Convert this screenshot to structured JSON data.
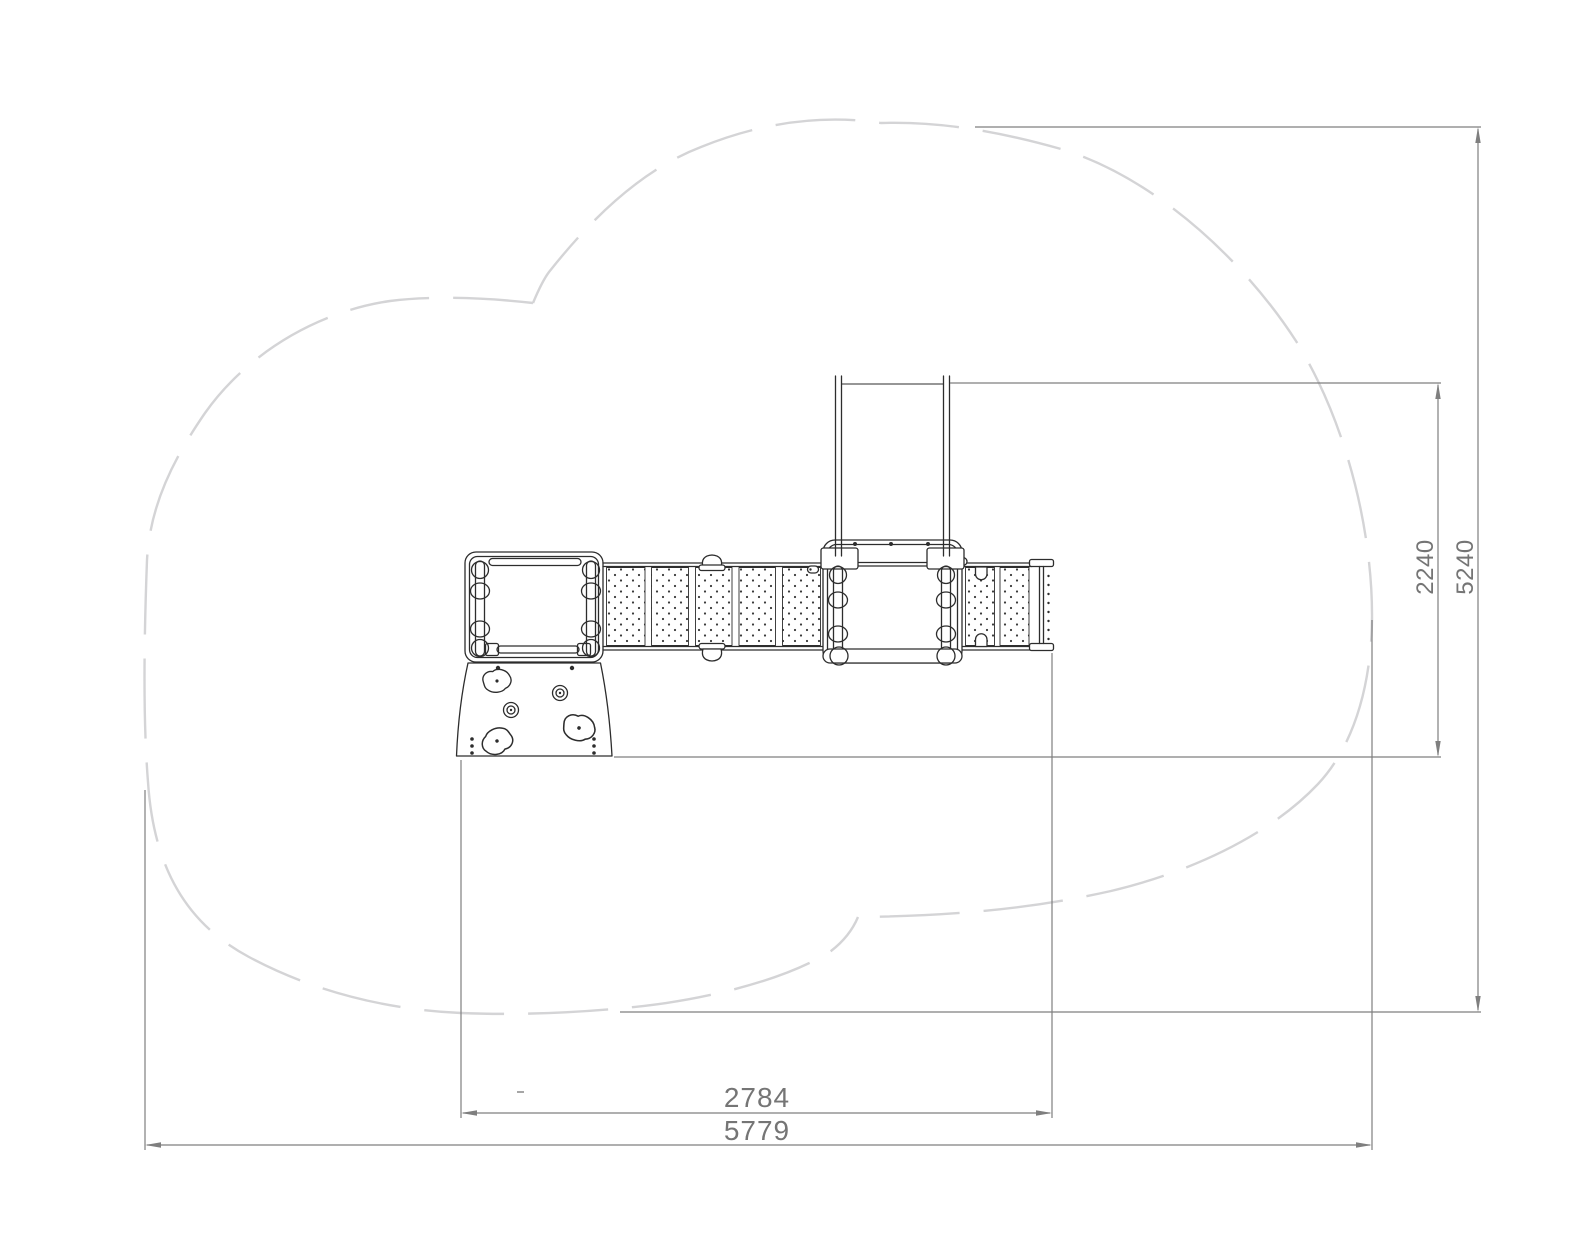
{
  "drawing": {
    "kind": "playground-equipment-top-view-plan",
    "background": "#ffffff"
  },
  "colors": {
    "equipment_line": "#2d2d2d",
    "dimension_line": "#7f7f7f",
    "dimension_text": "#757575",
    "safety_outline": "#d4d4d6",
    "panel_dot": "#3a3a3a"
  },
  "dims": {
    "structure_depth": {
      "label": "2240",
      "orientation": "vertical"
    },
    "zone_depth": {
      "label": "5240",
      "orientation": "vertical"
    },
    "structure_width": {
      "label": "2784",
      "orientation": "horizontal"
    },
    "zone_width": {
      "label": "5779",
      "orientation": "horizontal"
    }
  }
}
